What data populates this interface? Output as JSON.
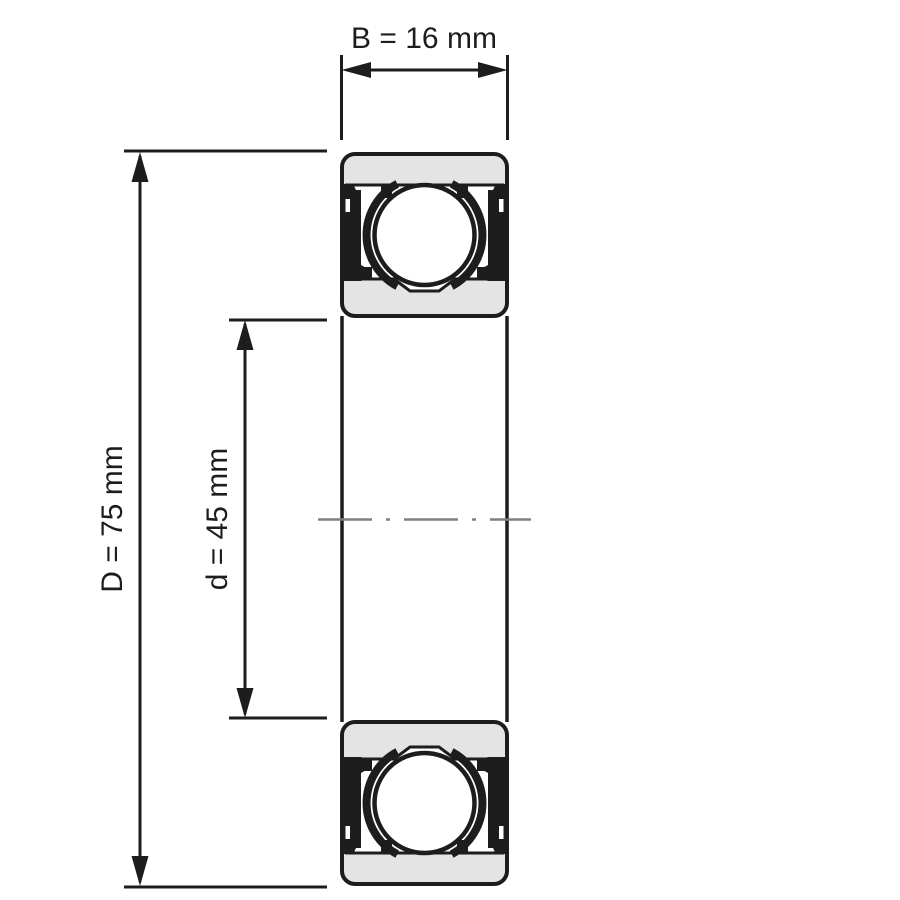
{
  "diagram": {
    "kind": "deep-groove-ball-bearing-cross-section",
    "dimensions": {
      "B": {
        "label": "B = 16 mm",
        "symbol": "B",
        "value_mm": 16
      },
      "D": {
        "label": "D = 75 mm",
        "symbol": "D",
        "value_mm": 75
      },
      "d": {
        "label": "d = 45 mm",
        "symbol": "d",
        "value_mm": 45
      }
    },
    "colors": {
      "line": "#1d1d1d",
      "ring_fill": "#e4e4e4",
      "ball_fill": "#ffffff",
      "centerline": "#7f7f7f",
      "background": "#ffffff"
    }
  }
}
